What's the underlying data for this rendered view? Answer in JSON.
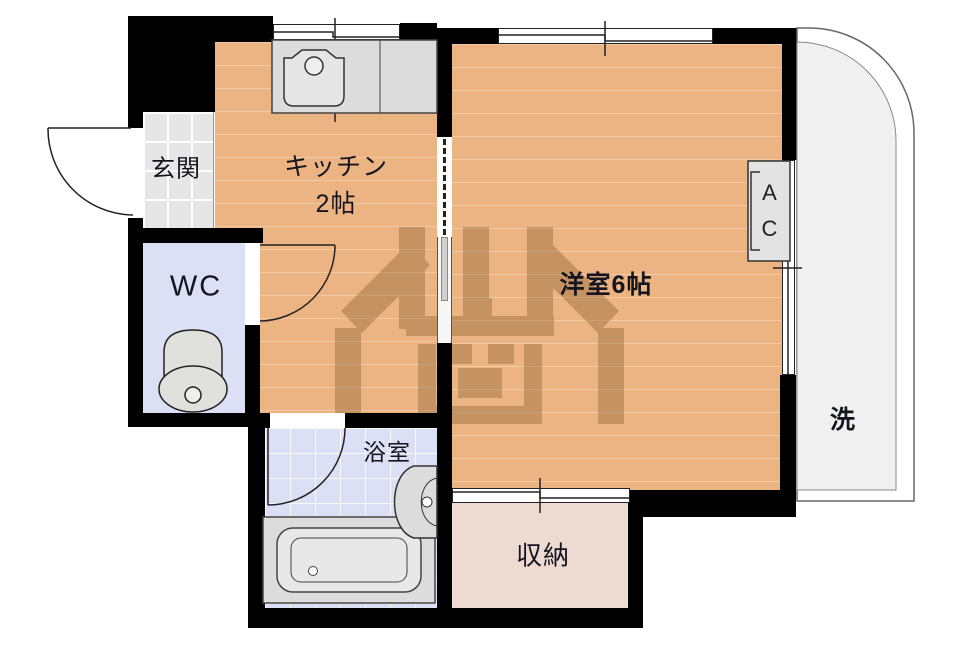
{
  "title": "間取り図",
  "rooms": {
    "genkan": {
      "label": "玄関"
    },
    "kitchen": {
      "label": "キッチン",
      "size": "2帖"
    },
    "wc": {
      "label": "WC"
    },
    "living": {
      "label": "洋室6帖"
    },
    "bath": {
      "label": "浴室"
    },
    "storage": {
      "label": "収納"
    },
    "laundry": {
      "label": "洗"
    },
    "aircon": {
      "top": "A",
      "bottom": "C"
    }
  },
  "watermark": {
    "text": "川商"
  },
  "colors": {
    "wood": "#ecb482",
    "blue": "#dbe0f5",
    "genkan": "#e6e6e6",
    "storage": "#eddbd2",
    "fixture": "#dcdcdc",
    "wall": "#000000",
    "balcony": "#f0f0f0",
    "wmark": "#8d6132"
  }
}
